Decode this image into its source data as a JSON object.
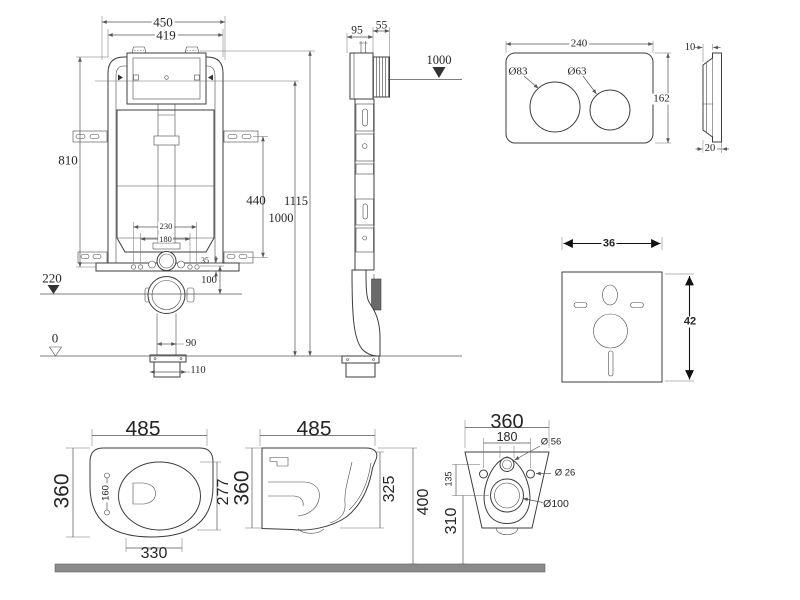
{
  "cistern_front_view": {
    "frame_width": "450",
    "tank_width": "419",
    "frame_height": "810",
    "bracket_spacing": "440",
    "total_height": "1115",
    "window_height": "1000",
    "bolt_spacing_outer": "230",
    "bolt_spacing_inner": "180",
    "plate_thickness": "35",
    "outlet_drop": "100",
    "outlet_level": "220",
    "floor_level": "0",
    "outlet_pipe_width": "90",
    "base_flange_width": "110"
  },
  "cistern_side_view": {
    "frame_depth": "95",
    "tank_depth": "55",
    "reference_level": "1000"
  },
  "flush_plate": {
    "width": "240",
    "height": "162",
    "large_button_diameter": "Ø83",
    "small_button_diameter": "Ø63",
    "thickness_top": "10",
    "thickness_bottom": "20"
  },
  "sound_mat": {
    "width": "36",
    "height": "42"
  },
  "toilet_top_view": {
    "depth": "485",
    "width": "360",
    "hinge_hole_spacing": "160",
    "bowl_opening_depth": "277",
    "seat_depth": "330"
  },
  "toilet_side_view": {
    "depth": "485",
    "rear_height": "360",
    "front_height": "325",
    "mount_height": "400"
  },
  "toilet_back_view": {
    "width": "360",
    "fixing_hole_spacing": "180",
    "water_inlet_diameter": "Ø 56",
    "fixing_hole_diameter": "Ø 26",
    "inlet_to_outlet": "135",
    "outlet_diameter": "Ø100",
    "outlet_height": "310"
  }
}
